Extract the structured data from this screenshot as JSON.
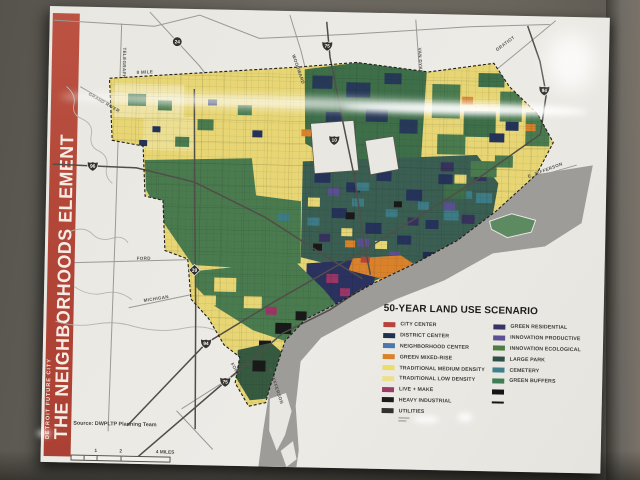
{
  "banner": {
    "supertitle": "DETROIT FUTURE CITY",
    "title": "THE NEIGHBORHOODS ELEMENT",
    "color": "#b04436"
  },
  "map": {
    "road_labels": [
      "TELEGRAPH",
      "GRAND RIVER",
      "8 MILE",
      "WOODWARD",
      "VAN DYKE",
      "GRATIOT",
      "E. JEFFERSON",
      "FORD",
      "MICHIGAN",
      "FORT",
      "W. JEFFERSON"
    ],
    "shields": [
      "24",
      "75",
      "10",
      "94",
      "96",
      "39",
      "94",
      "75"
    ],
    "colors": {
      "water": "#9d9c98",
      "land_yellow": "#e8d674",
      "land_green": "#4a7b4f"
    }
  },
  "legend": {
    "title": "50-YEAR LAND USE SCENARIO",
    "columns": [
      {
        "items": [
          {
            "label": "CITY CENTER",
            "color": "#b5443c"
          },
          {
            "label": "DISTRICT CENTER",
            "color": "#20304f"
          },
          {
            "label": "NEIGHBORHOOD CENTER",
            "color": "#4b77ab"
          },
          {
            "label": "GREEN MIXED-RISE",
            "color": "#d9822b"
          },
          {
            "label": "TRADITIONAL MEDIUM DENSITY",
            "color": "#eddc66"
          },
          {
            "label": "TRADITIONAL LOW DENSITY",
            "color": "#eedf8e"
          },
          {
            "label": "LIVE + MAKE",
            "color": "#9c3a68"
          },
          {
            "label": "HEAVY INDUSTRIAL",
            "color": "#1c1c1c"
          },
          {
            "label": "UTILITIES",
            "color": "#32322f"
          }
        ]
      },
      {
        "items": [
          {
            "label": "GREEN RESIDENTIAL",
            "color": "#3a3464"
          },
          {
            "label": "INNOVATION PRODUCTIVE",
            "color": "#5c5096"
          },
          {
            "label": "INNOVATION ECOLOGICAL",
            "color": "#4d7c45"
          },
          {
            "label": "LARGE PARK",
            "color": "#2f5048"
          },
          {
            "label": "CEMETERY",
            "color": "#40808b"
          },
          {
            "label": "GREEN BUFFERS",
            "color": "#3f7d54"
          },
          {
            "label": "",
            "color": "#151515"
          },
          {
            "label": "",
            "color": "#151515"
          }
        ]
      }
    ]
  },
  "footer": {
    "source": "Source: DWPLTP Planning Team",
    "scale_labels": [
      "1",
      "2",
      "4 MILES"
    ]
  }
}
